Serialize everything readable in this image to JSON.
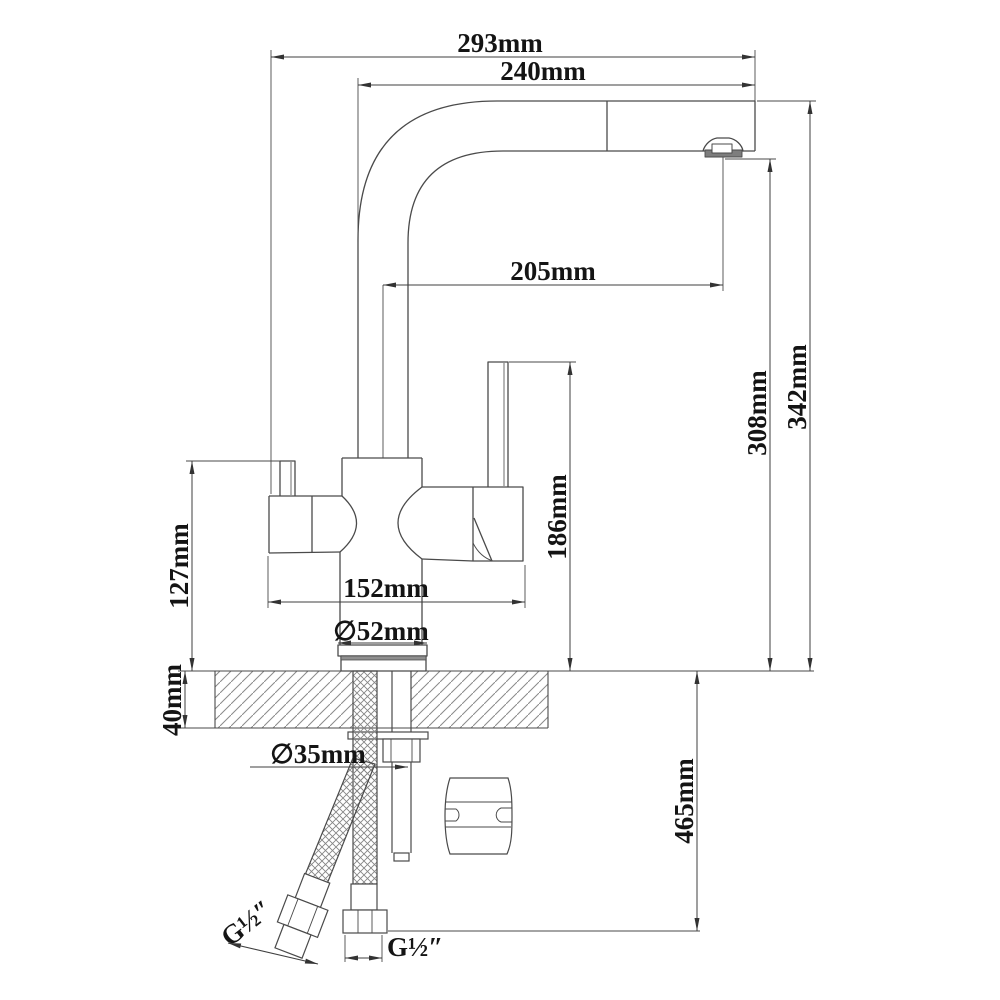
{
  "drawing": {
    "dims": {
      "w293": "293mm",
      "w240": "240mm",
      "w205": "205mm",
      "h342": "342mm",
      "h308": "308mm",
      "h186": "186mm",
      "h127": "127mm",
      "w152": "152mm",
      "d52": "∅52mm",
      "d35": "∅35mm",
      "t40": "40mm",
      "h465": "465mm",
      "thread_left": "G½″",
      "thread_bottom": "G½″"
    },
    "colors": {
      "line": "#4a4a4a",
      "dim_line": "#3f3f3f",
      "hatch": "#8a8a8a",
      "aerator_fill": "#7d7d7d"
    }
  }
}
